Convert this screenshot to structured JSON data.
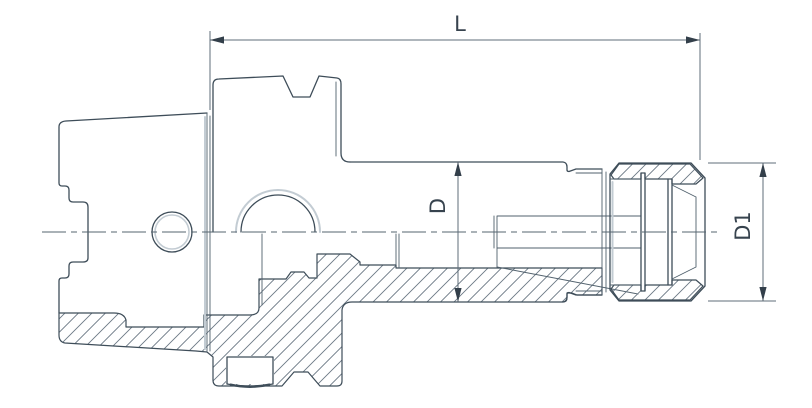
{
  "drawing": {
    "type": "technical-section-drawing",
    "subject": "collet-chuck-tool-holder-cross-section",
    "dimension_labels": {
      "overall_length": "L",
      "body_diameter": "D",
      "nut_diameter": "D1"
    },
    "colors": {
      "background": "#ffffff",
      "outline": "#3e4d59",
      "hatch": "#6a7884",
      "dimension_lines": "#5f6d79",
      "label_text": "#37434e",
      "soft_shading": "#c3ccd3"
    }
  }
}
